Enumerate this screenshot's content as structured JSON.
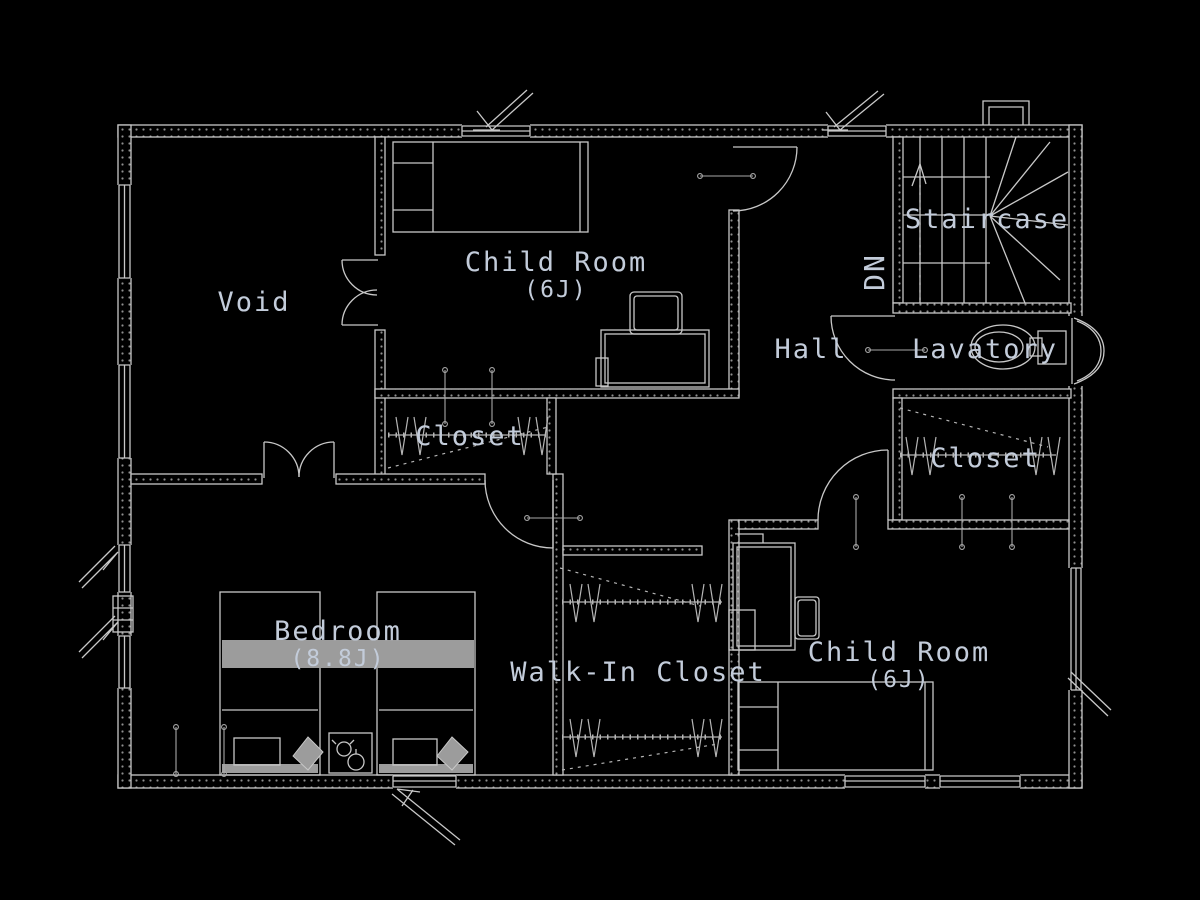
{
  "colors": {
    "background": "#000000",
    "line": "#c8c8c8",
    "dim_line": "#a8a8a8",
    "text": "#c3ccda",
    "blanket_fill": "#9c9c9c"
  },
  "rooms": {
    "void": {
      "label": "Void"
    },
    "child_room_1": {
      "label": "Child Room",
      "size": "(6J)"
    },
    "staircase": {
      "label": "Staircase",
      "direction": "DN"
    },
    "hall": {
      "label": "Hall"
    },
    "lavatory": {
      "label": "Lavatory"
    },
    "closet_1": {
      "label": "Closet"
    },
    "closet_2": {
      "label": "Closet"
    },
    "bedroom": {
      "label": "Bedroom",
      "size": "(8.8J)"
    },
    "walk_in_closet": {
      "label": "Walk-In Closet"
    },
    "child_room_2": {
      "label": "Child Room",
      "size": "(6J)"
    }
  }
}
